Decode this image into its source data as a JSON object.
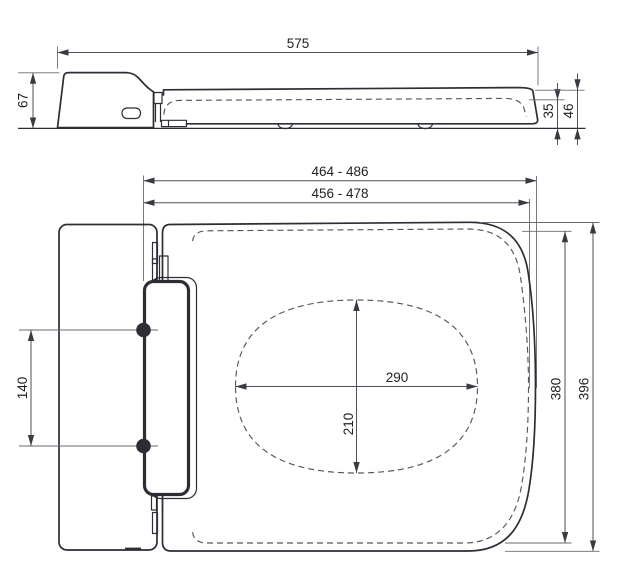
{
  "drawing_type": "technical-dimension-drawing",
  "side_view": {
    "length": "575",
    "height_rear": "67",
    "height_front_inner": "35",
    "height_front_outer": "46"
  },
  "plan_view": {
    "width_outer": "464 - 486",
    "width_inner": "456 - 478",
    "hinge_centers": "140",
    "opening_width": "290",
    "opening_depth": "210",
    "depth_inner": "380",
    "depth_outer": "396"
  },
  "colors": {
    "object_line": "#2d2d36",
    "dimension_line": "#50505a",
    "background": "#ffffff"
  }
}
